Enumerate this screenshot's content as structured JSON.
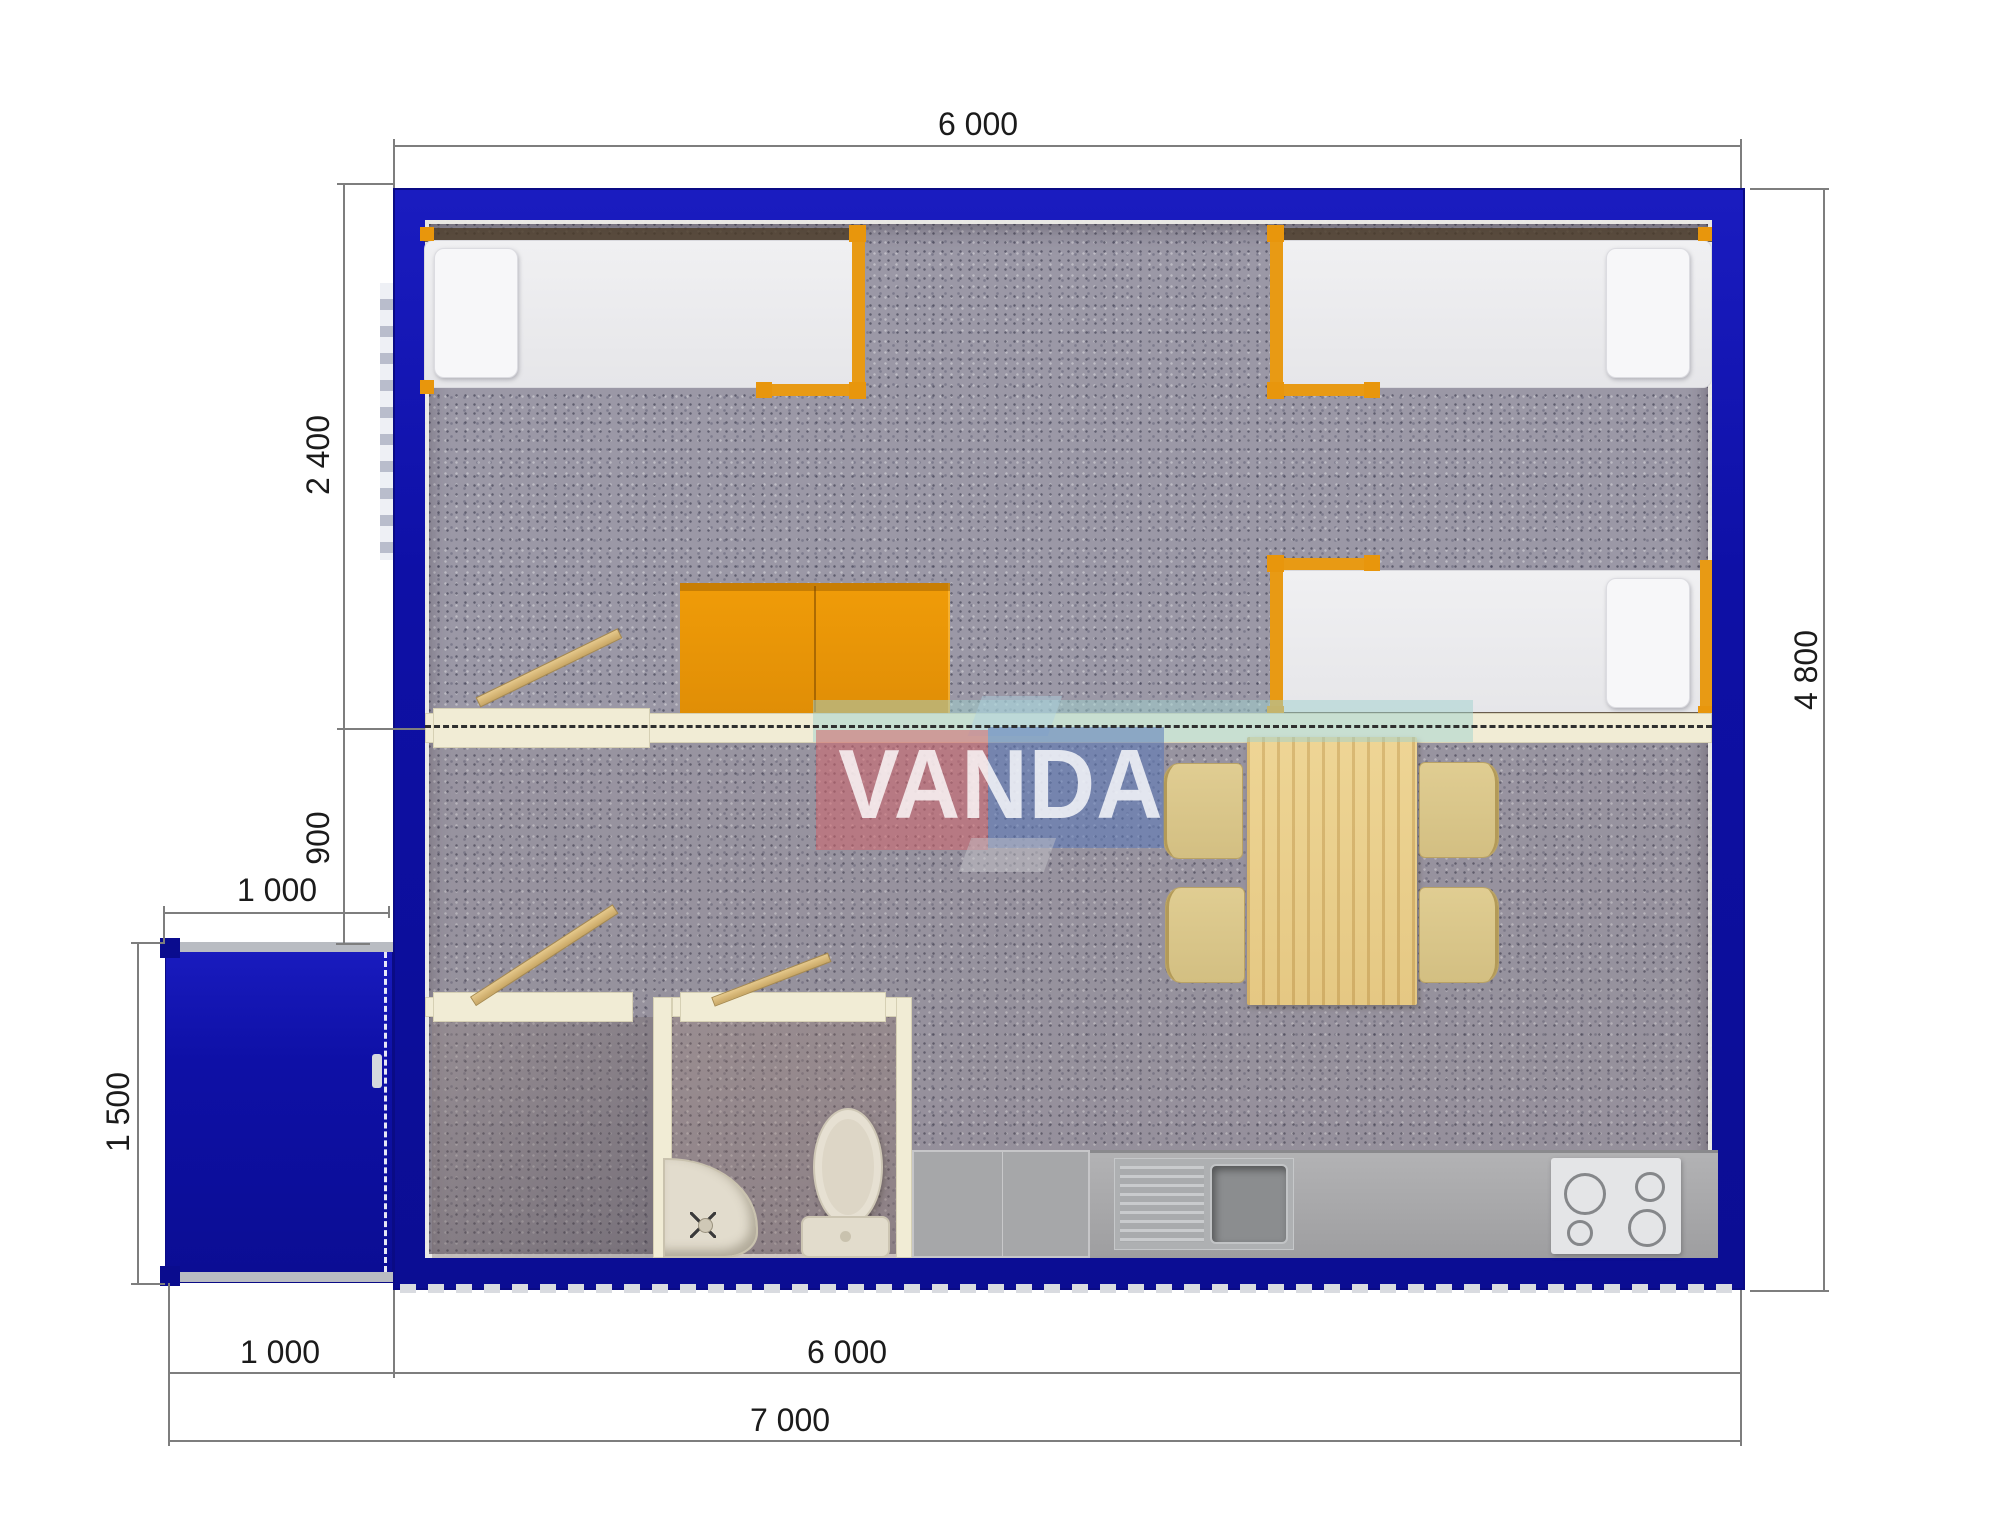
{
  "watermark": {
    "text": "VANDA"
  },
  "dimensions": {
    "top_width": "6 000",
    "right_height": "4 800",
    "left_bedroom_depth": "2 400",
    "left_hall_depth": "900",
    "porch_width_top": "1 000",
    "porch_depth": "1 500",
    "bottom_porch_width": "1 000",
    "bottom_building_width": "6 000",
    "bottom_total_width": "7 000"
  },
  "colors": {
    "wall_blue": "#0e10a6",
    "floor_carpet": "#9b98a6",
    "partition_cream": "#f1ecd5",
    "furniture_orange": "#e8960c",
    "door_wood": "#d8b878",
    "table_wood": "#ecd293",
    "chair_tan": "#dcc98c",
    "counter_gray": "#a9aaac",
    "logo_red": "#d2646e",
    "logo_blue": "#5a78b9",
    "logo_teal": "#a0d2cd"
  }
}
